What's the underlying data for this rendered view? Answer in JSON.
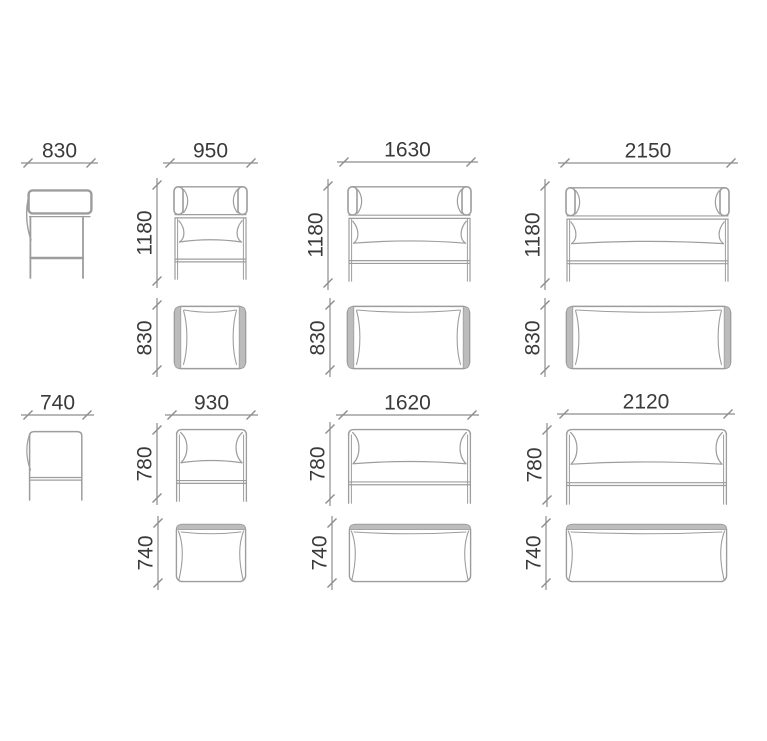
{
  "colors": {
    "line": "#9d9d9d",
    "cushion_fill": "#bcbcbc",
    "dimension_line": "#8d8d8d",
    "label_text": "#3a3a3a",
    "background": "#ffffff"
  },
  "dims": {
    "high": {
      "side": {
        "width": "830"
      },
      "armchair": {
        "width": "950",
        "height": "1180",
        "depth": "830"
      },
      "sofa2": {
        "width": "1630",
        "height": "1180",
        "depth": "830"
      },
      "sofa3": {
        "width": "2150",
        "height": "1180",
        "depth": "830"
      }
    },
    "low": {
      "side": {
        "width": "740"
      },
      "armchair": {
        "width": "930",
        "height": "780",
        "depth": "740"
      },
      "sofa2": {
        "width": "1620",
        "height": "780",
        "depth": "740"
      },
      "sofa3": {
        "width": "2120",
        "height": "780",
        "depth": "740"
      }
    }
  }
}
